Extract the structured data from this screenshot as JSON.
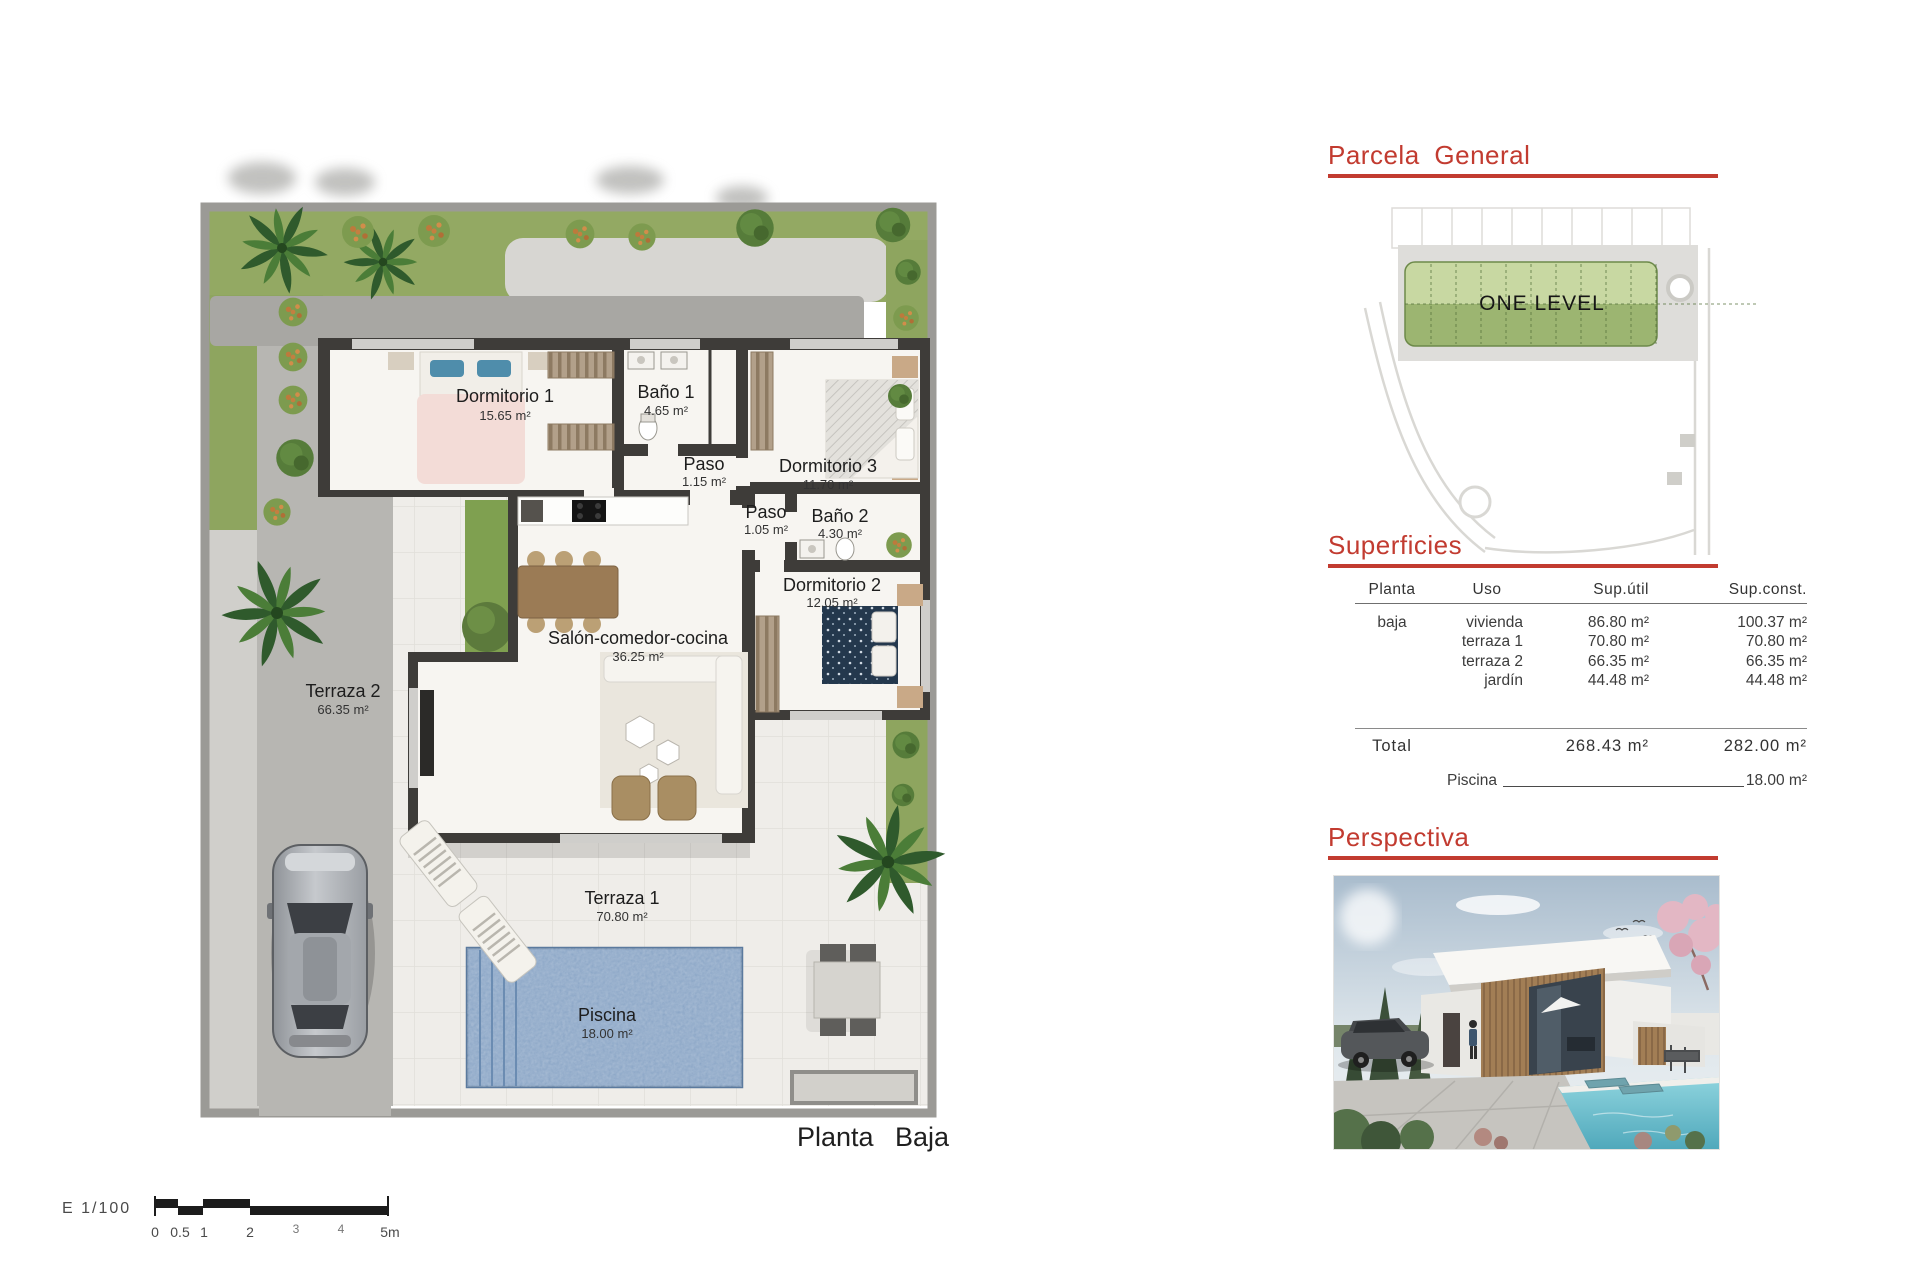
{
  "colors": {
    "accent_red": "#c23b30",
    "grass": "#93a963",
    "concrete": "#b7b6b2",
    "pool_blue": "#7e9cc0",
    "wall_dark": "#3e3c39"
  },
  "plan": {
    "title": "Planta Baja",
    "rooms": [
      {
        "name": "Dormitorio 1",
        "area": "15.65 m²"
      },
      {
        "name": "Baño 1",
        "area": "4.65 m²"
      },
      {
        "name": "Paso",
        "area": "1.15 m²"
      },
      {
        "name": "Dormitorio 3",
        "area": "11.70 m²"
      },
      {
        "name": "Paso",
        "area": "1.05 m²"
      },
      {
        "name": "Baño 2",
        "area": "4.30 m²"
      },
      {
        "name": "Dormitorio 2",
        "area": "12.05 m²"
      },
      {
        "name": "Salón-comedor-cocina",
        "area": "36.25 m²"
      },
      {
        "name": "Terraza 2",
        "area": "66.35 m²"
      },
      {
        "name": "Terraza 1",
        "area": "70.80 m²"
      },
      {
        "name": "Piscina",
        "area": "18.00 m²"
      }
    ],
    "scale": {
      "label": "E 1/100",
      "ticks": [
        "0",
        "0.5",
        "1",
        "2",
        "3",
        "4",
        "5m"
      ]
    }
  },
  "parcela": {
    "title": "Parcela General",
    "plot_label": "ONE LEVEL"
  },
  "superficies": {
    "title": "Superficies",
    "columns": [
      "Planta",
      "Uso",
      "Sup.útil",
      "Sup.const."
    ],
    "rows": [
      {
        "planta": "baja",
        "uso": "vivienda",
        "util": "86.80 m²",
        "const": "100.37 m²"
      },
      {
        "planta": "",
        "uso": "terraza 1",
        "util": "70.80 m²",
        "const": "70.80 m²"
      },
      {
        "planta": "",
        "uso": "terraza 2",
        "util": "66.35 m²",
        "const": "66.35 m²"
      },
      {
        "planta": "",
        "uso": "jardín",
        "util": "44.48 m²",
        "const": "44.48 m²"
      }
    ],
    "total": {
      "label": "Total",
      "util": "268.43 m²",
      "const": "282.00 m²"
    },
    "piscina": {
      "label": "Piscina",
      "value": "18.00 m²"
    }
  },
  "perspectiva": {
    "title": "Perspectiva"
  }
}
